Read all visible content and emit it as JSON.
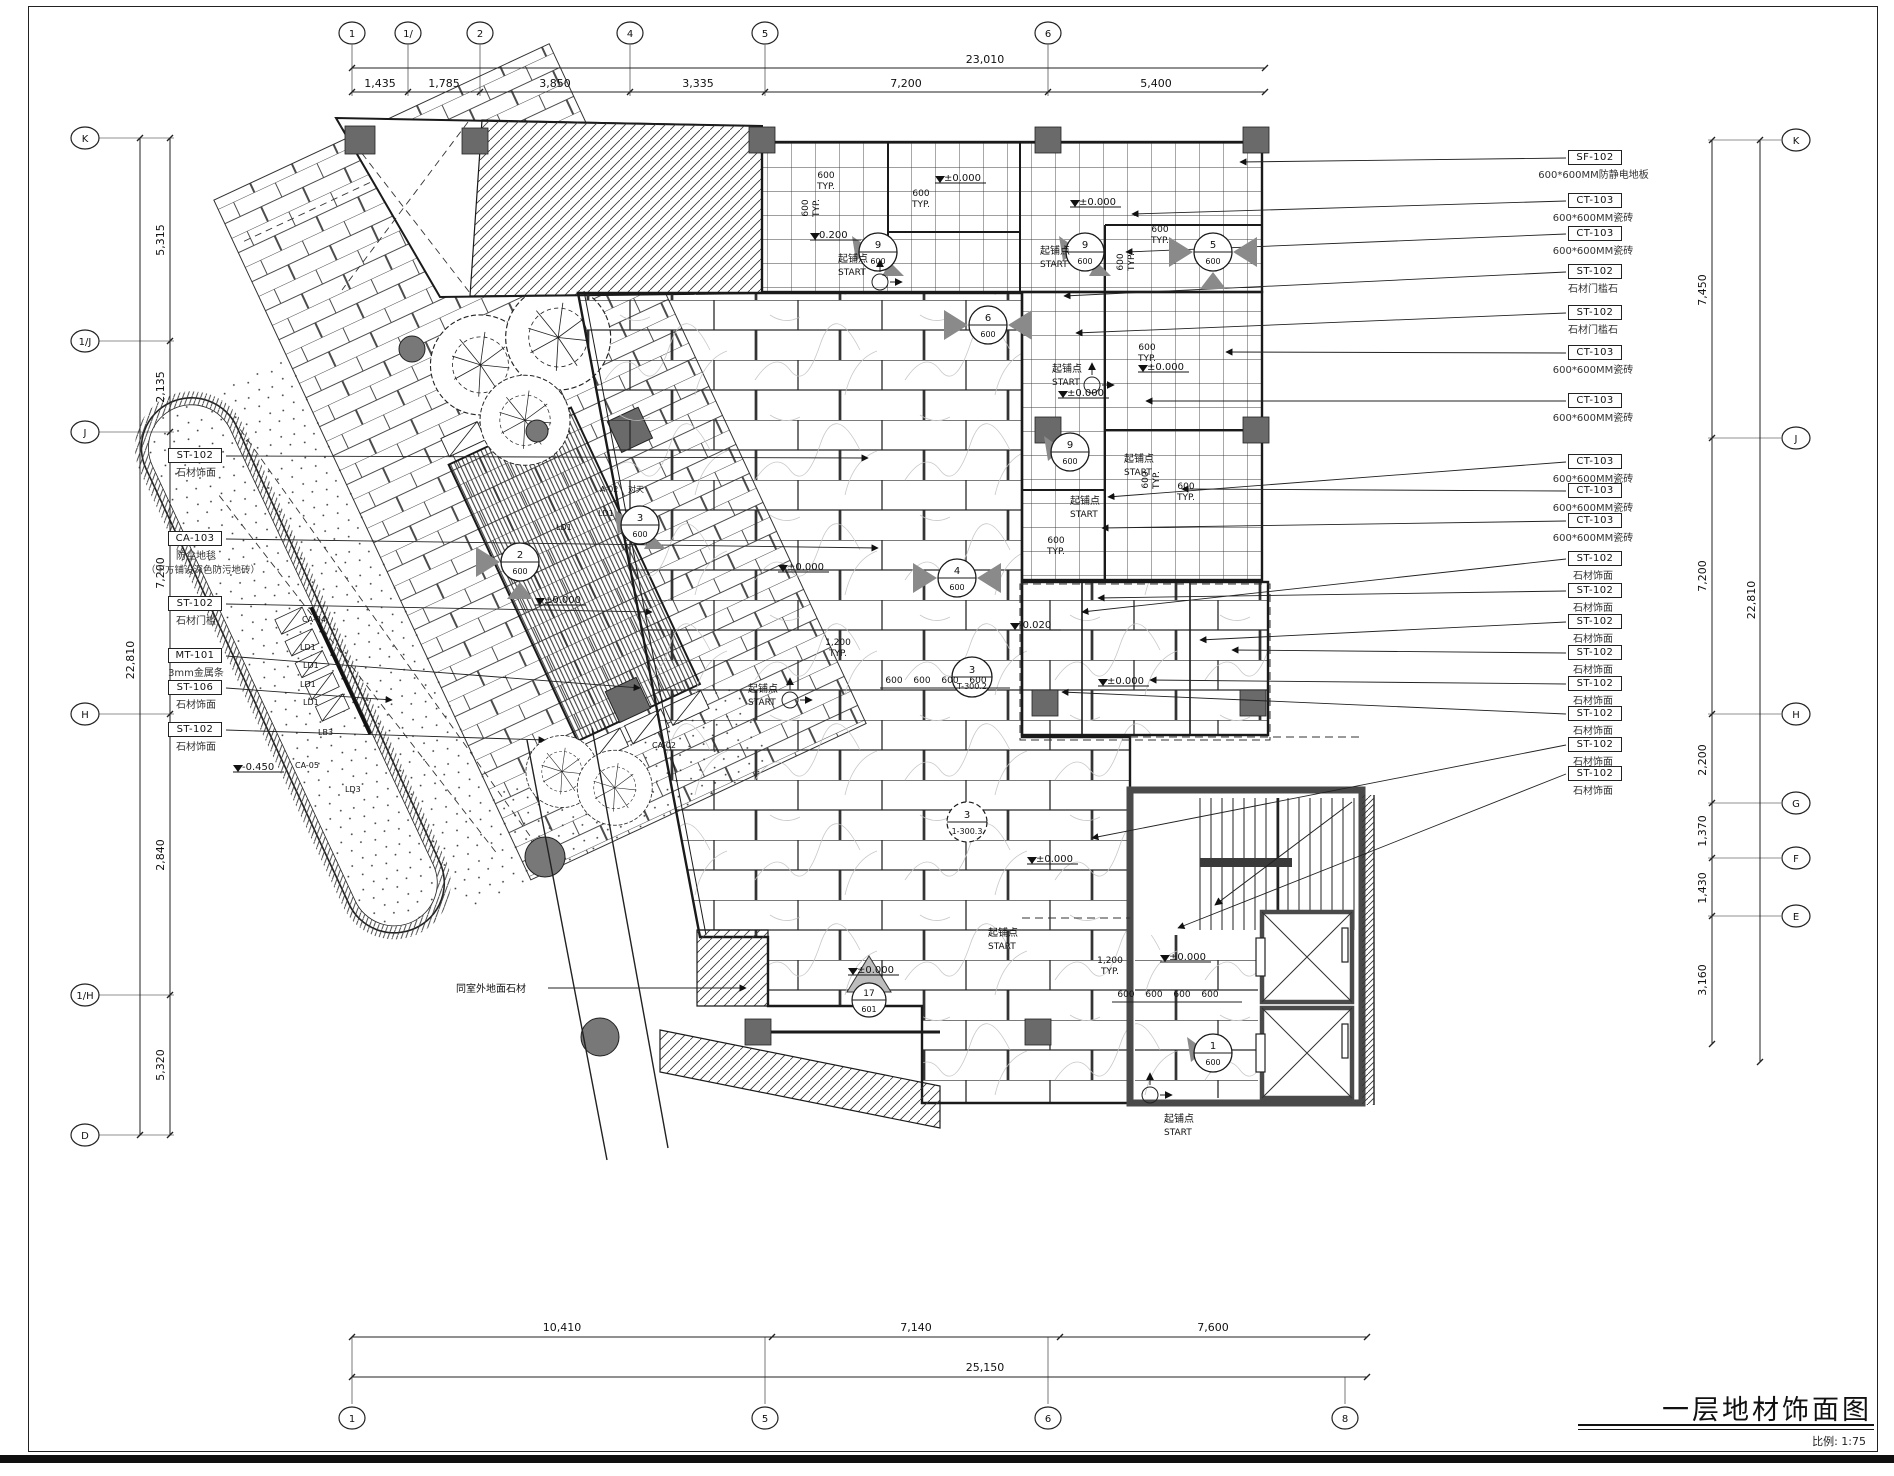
{
  "title": {
    "text": "一层地材饰面图",
    "scale": "比例: 1:75"
  },
  "grid": {
    "top": {
      "bubbles": [
        "1",
        "1/",
        "2",
        "4",
        "5",
        "6"
      ],
      "total": "23,010",
      "dims": [
        "1,435",
        "1,785",
        "3,850",
        "3,335",
        "7,200",
        "5,400"
      ]
    },
    "bottom": {
      "bubbles": [
        "1",
        "5",
        "6",
        "8"
      ],
      "total": "25,150",
      "dims": [
        "10,410",
        "7,140",
        "7,600"
      ]
    },
    "left": {
      "bubbles": [
        "K",
        "1/J",
        "J",
        "H",
        "1/H",
        "D"
      ],
      "total": "22,810",
      "dims": [
        "5,315",
        "2,135",
        "7,200",
        "2,840",
        "5,320"
      ]
    },
    "right": {
      "bubbles": [
        "K",
        "J",
        "H",
        "G",
        "F",
        "E"
      ],
      "total": "22,810",
      "dims": [
        "7,450",
        "7,200",
        "2,200",
        "1,370",
        "1,430",
        "3,160"
      ]
    }
  },
  "right_labels": [
    {
      "code": "SF-102",
      "desc": "600*600MM防静电地板"
    },
    {
      "code": "CT-103",
      "desc": "600*600MM瓷砖"
    },
    {
      "code": "CT-103",
      "desc": "600*600MM瓷砖"
    },
    {
      "code": "ST-102",
      "desc": "石材门槛石"
    },
    {
      "code": "ST-102",
      "desc": "石材门槛石"
    },
    {
      "code": "CT-103",
      "desc": "600*600MM瓷砖"
    },
    {
      "code": "CT-103",
      "desc": "600*600MM瓷砖"
    },
    {
      "code": "CT-103",
      "desc": "600*600MM瓷砖"
    },
    {
      "code": "CT-103",
      "desc": "600*600MM瓷砖"
    },
    {
      "code": "CT-103",
      "desc": "600*600MM瓷砖"
    },
    {
      "code": "ST-102",
      "desc": "石材饰面"
    },
    {
      "code": "ST-102",
      "desc": "石材饰面"
    },
    {
      "code": "ST-102",
      "desc": "石材饰面"
    },
    {
      "code": "ST-102",
      "desc": "石材饰面"
    },
    {
      "code": "ST-102",
      "desc": "石材饰面"
    },
    {
      "code": "ST-102",
      "desc": "石材饰面"
    },
    {
      "code": "ST-102",
      "desc": "石材饰面"
    },
    {
      "code": "ST-102",
      "desc": "石材饰面"
    }
  ],
  "left_labels": [
    {
      "code": "ST-102",
      "desc": "石材饰面"
    },
    {
      "code": "CA-103",
      "desc": "防尘地毯",
      "desc2": "（下方铺设深色防污地砖）"
    },
    {
      "code": "ST-102",
      "desc": "石材门槛"
    },
    {
      "code": "MT-101",
      "desc": "3mm金属条"
    },
    {
      "code": "ST-106",
      "desc": "石材饰面"
    },
    {
      "code": "ST-102",
      "desc": "石材饰面"
    }
  ],
  "annotations": {
    "start": {
      "l1": "起铺点",
      "l2": "START"
    },
    "typ600": {
      "l1": "600",
      "l2": "TYP."
    },
    "typ1200": {
      "l1": "1,200",
      "l2": "TYP."
    },
    "d600": "600",
    "levels": {
      "zero": "±0.000",
      "n020": "-0.020",
      "n200": "0.200",
      "n450": "-0.450"
    },
    "ext_note": "同室外地面石材",
    "tags": {
      "a02": "A-02",
      "ca02": "CA-02",
      "ca04": "CA-04",
      "ca05": "CA-05",
      "ld1": "LD1",
      "ld3": "LD3",
      "lb3": "LB3",
      "duitian": "对天"
    }
  },
  "markers": [
    {
      "num": "9",
      "den": "600"
    },
    {
      "num": "9",
      "den": "600"
    },
    {
      "num": "5",
      "den": "600"
    },
    {
      "num": "6",
      "den": "600"
    },
    {
      "num": "9",
      "den": "600"
    },
    {
      "num": "3",
      "den": "600"
    },
    {
      "num": "2",
      "den": "600"
    },
    {
      "num": "4",
      "den": "600"
    },
    {
      "num": "3",
      "den": "T-300.2"
    },
    {
      "num": "3",
      "den": "1-300.3"
    },
    {
      "num": "17",
      "den": "601"
    },
    {
      "num": "1",
      "den": "600"
    }
  ]
}
